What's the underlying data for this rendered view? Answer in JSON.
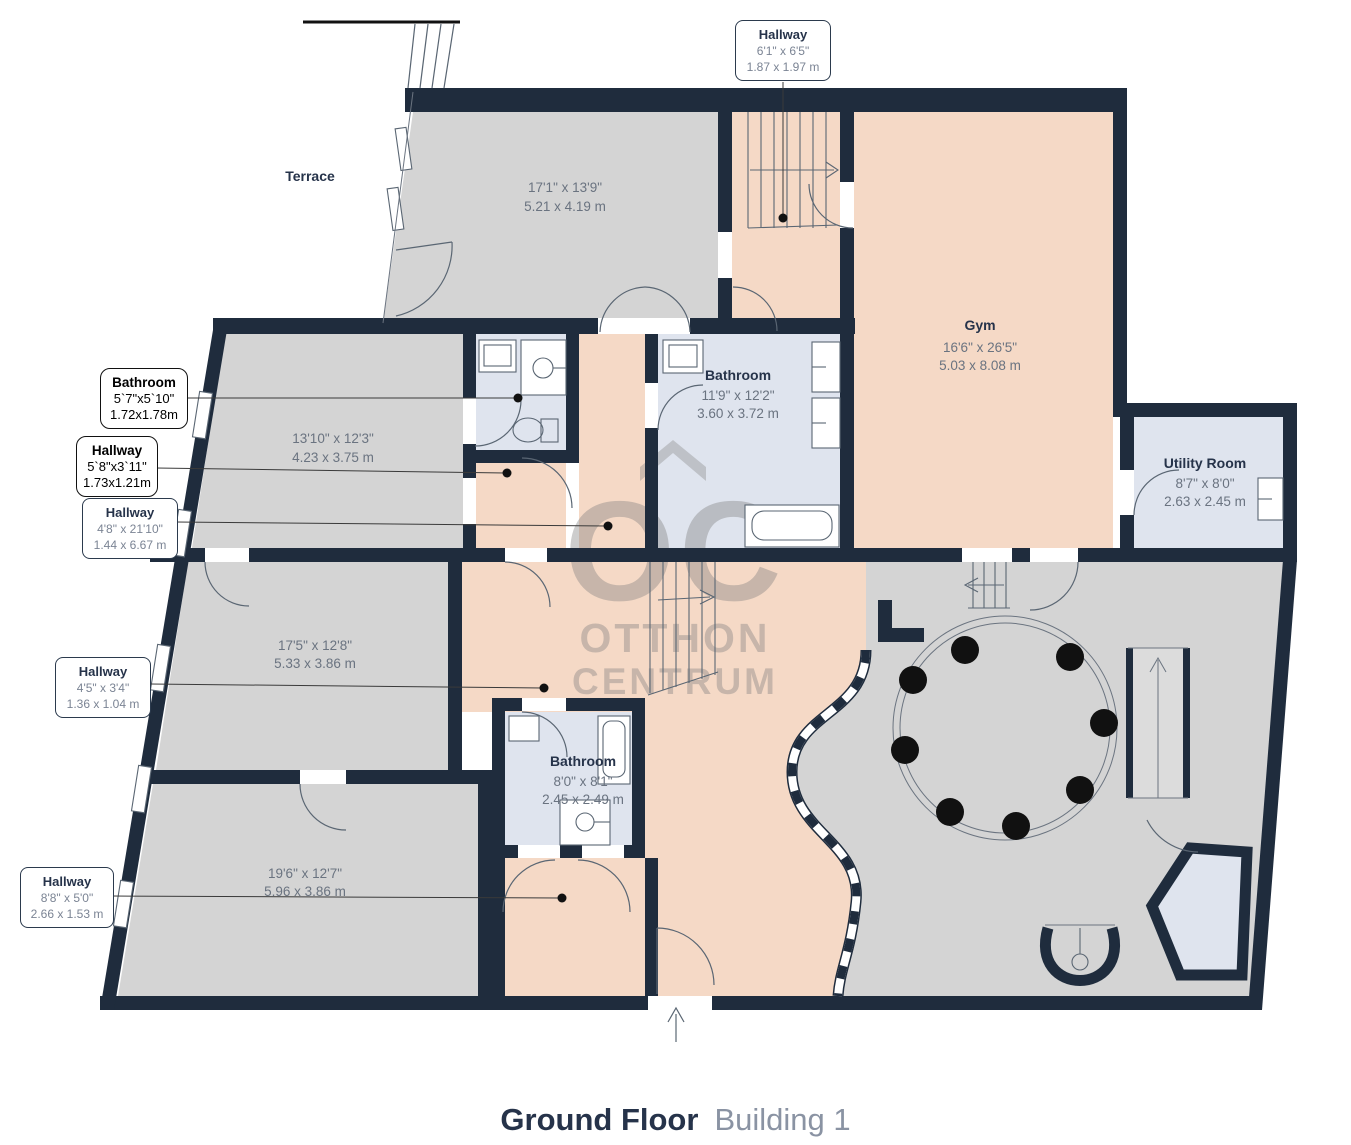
{
  "title": {
    "main": "Ground Floor",
    "sub": "Building 1"
  },
  "watermark": {
    "oc": "OC",
    "otthon": "OTTHON",
    "centrum": "CENTRUM"
  },
  "colors": {
    "wall": "#1f2c3d",
    "floor_gray": "#d4d4d4",
    "floor_salmon": "#f5d9c6",
    "floor_blue": "#dfe4ee",
    "title_navy": "#26334a",
    "title_gray": "#8a93a3",
    "dims_gray": "#6a7380"
  },
  "rooms": {
    "terrace": {
      "label": "Terrace"
    },
    "r171": {
      "ft": "17'1\" x 13'9\"",
      "m": "5.21 x 4.19 m"
    },
    "r1310": {
      "ft": "13'10\" x 12'3\"",
      "m": "4.23 x 3.75 m"
    },
    "bath_mid": {
      "label": "Bathroom",
      "ft": "11'9\" x 12'2\"",
      "m": "3.60 x 3.72 m"
    },
    "gym": {
      "label": "Gym",
      "ft": "16'6\" x 26'5\"",
      "m": "5.03 x 8.08 m"
    },
    "utility": {
      "label": "Utility Room",
      "ft": "8'7\" x 8'0\"",
      "m": "2.63 x 2.45 m"
    },
    "r175": {
      "ft": "17'5\" x 12'8\"",
      "m": "5.33 x 3.86 m"
    },
    "bath_small": {
      "label": "Bathroom",
      "ft": "8'0\" x 8'1\"",
      "m": "2.45 x 2.49 m"
    },
    "r196": {
      "ft": "19'6\" x 12'7\"",
      "m": "5.96 x 3.86 m"
    }
  },
  "callouts": {
    "hall_top": {
      "title": "Hallway",
      "ft": "6'1\" x 6'5\"",
      "m": "1.87 x 1.97 m"
    },
    "bath_left": {
      "title": "Bathroom",
      "ft": "5`7\"x5`10\"",
      "m": "1.72x1.78m"
    },
    "hall_a": {
      "title": "Hallway",
      "ft": "5`8\"x3`11\"",
      "m": "1.73x1.21m"
    },
    "hall_b": {
      "title": "Hallway",
      "ft": "4'8\" x 21'10\"",
      "m": "1.44 x 6.67 m"
    },
    "hall_c": {
      "title": "Hallway",
      "ft": "4'5\" x 3'4\"",
      "m": "1.36 x 1.04 m"
    },
    "hall_d": {
      "title": "Hallway",
      "ft": "8'8\" x 5'0\"",
      "m": "2.66 x 1.53 m"
    }
  }
}
